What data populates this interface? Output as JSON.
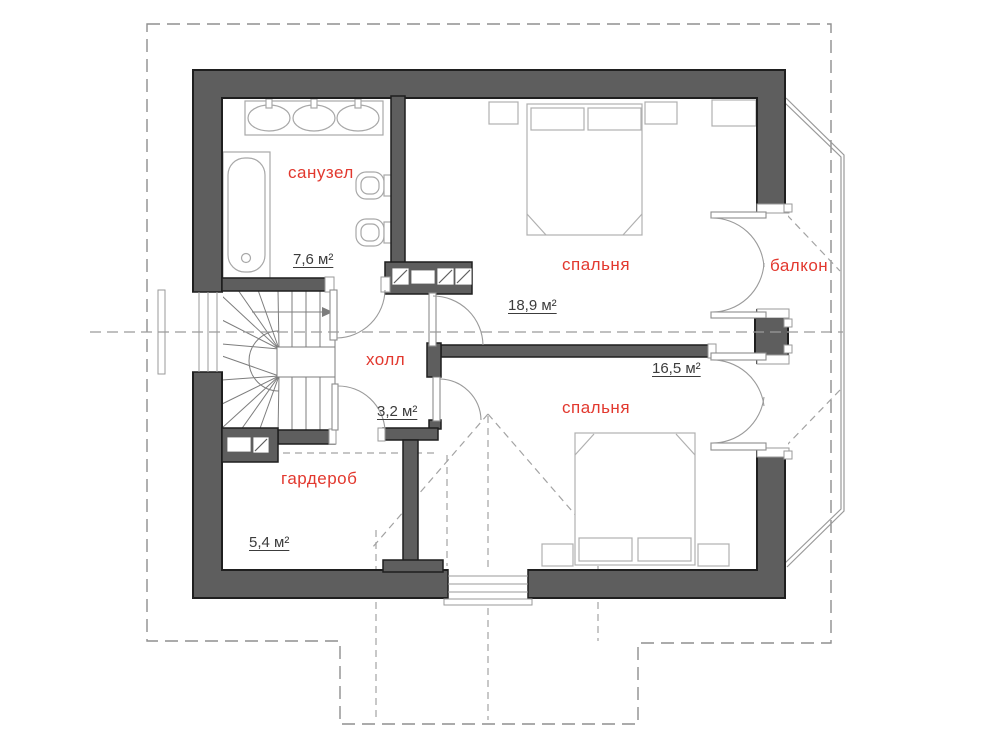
{
  "plan": {
    "floor_type": "attic floor plan",
    "rooms": {
      "bathroom": {
        "label": "санузел",
        "area": "7,6 м²"
      },
      "bedroom_top": {
        "label": "спальня",
        "area": "18,9 м²"
      },
      "balcony": {
        "label": "балкон"
      },
      "hall": {
        "label": "холл",
        "area": "3,2 м²"
      },
      "bedroom_bottom": {
        "label": "спальня",
        "area": "16,5 м²"
      },
      "wardrobe": {
        "label": "гардероб",
        "area": "5,4 м²"
      }
    },
    "colors": {
      "wall_fill": "#5e5e5e",
      "wall_stroke": "#1f1f1f",
      "room_label": "#e2382e",
      "area_label": "#3c3c3c",
      "dashed_line": "#999999",
      "thin_line": "#a8a8a8",
      "background": "#ffffff"
    }
  }
}
